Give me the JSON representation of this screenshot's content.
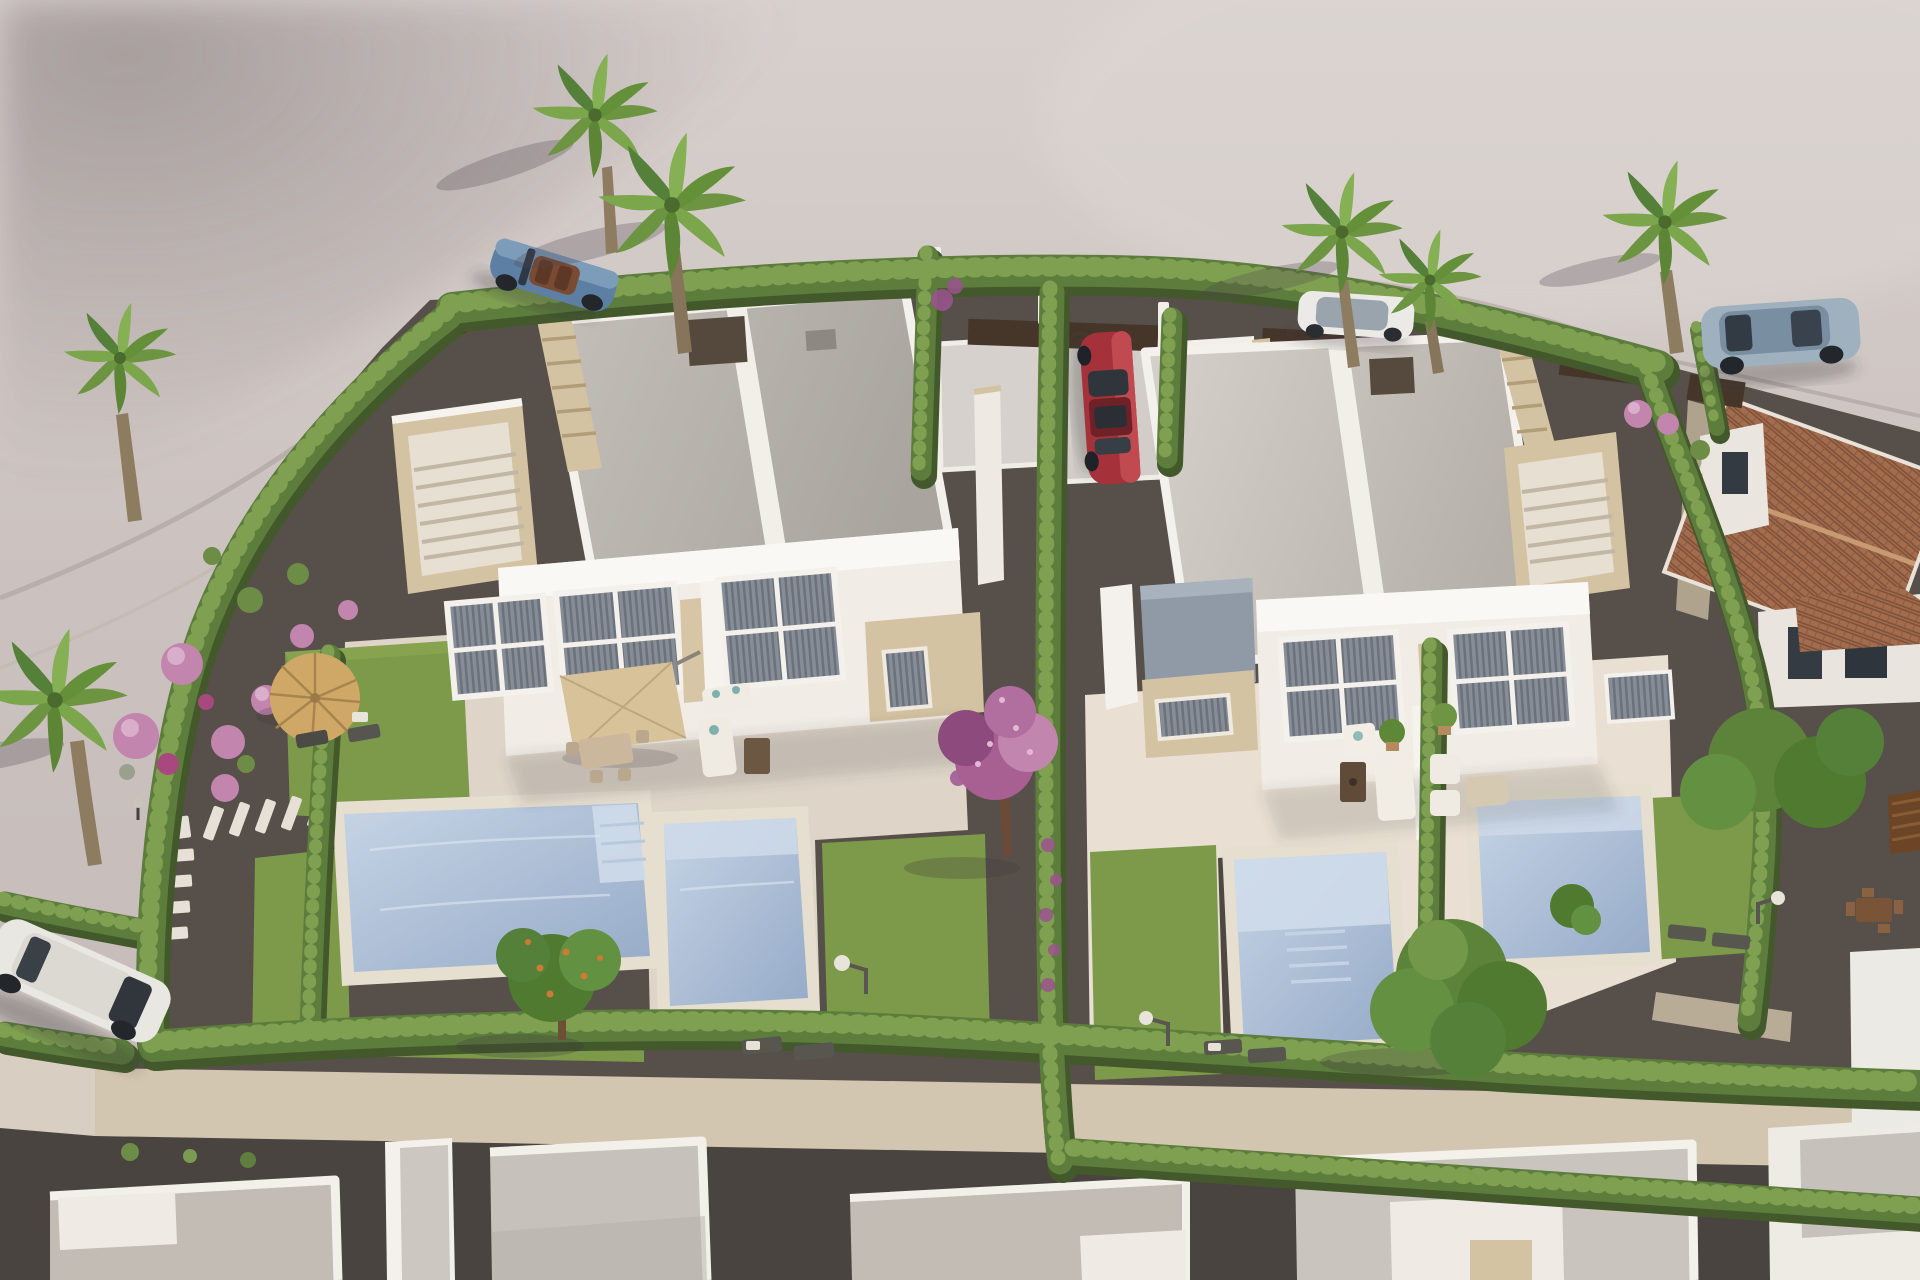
{
  "image": {
    "kind": "3d-architectural-render",
    "view": "aerial-oblique",
    "subject": "New-build residential development: two modern white duplex villas with private pools, lawned gardens, cypress hedges, palm trees, parked cars, a curving access road and neighbouring houses under construction",
    "lighting": "warm low sun from the upper right"
  },
  "inventory": {
    "duplex_villas": 2,
    "units_per_villa": 2,
    "private_pools": 4,
    "parked_cars": 5,
    "palm_trees": 7,
    "sun_parasols": 2,
    "tiled_roof_house": 1,
    "houses_under_construction_bottom": 5
  },
  "palette": {
    "road": "#cbc2bf",
    "road_light": "#d9d2cf",
    "road_shadow": "#a79d9b",
    "curb": "#b8aeab",
    "gravel": "#57504a",
    "sidewalk": "#d3c6b0",
    "bottom_road": "#49443f",
    "terrace": "#ded4c8",
    "terrace_light": "#e9dfd2",
    "lawn": "#7d9a4a",
    "hedge": "#5d7d3c",
    "hedge_light": "#7fa051",
    "hedge_dark": "#43592c",
    "pool_water": "#aec2d8",
    "pool_steps": "#cfdbea",
    "pool_coping": "#e6decf",
    "wall_white": "#f4f1ec",
    "wall_shaded": "#ddd7d0",
    "roof_gray": "#b7b2ac",
    "roof_light": "#ccc7c0",
    "stone_beige": "#d3c3a2",
    "stone_dark": "#b19e78",
    "window_glass": "#454c56",
    "fence_brown": "#46362a",
    "pergola_brown": "#6b4526",
    "tile_roof": "#a26c4e",
    "tile_dark": "#7e4f37",
    "palm_trunk": "#8d7c60",
    "palm_leaf": "#6d9440",
    "tree_green": "#55803a",
    "flower_pink": "#c285ad",
    "flower_magenta": "#9c5390",
    "car_blue": "#5d7fa3",
    "car_red": "#a5323a",
    "car_silver": "#9fb0bf",
    "car_white": "#eceae6",
    "porch_slate": "#8f9aa6",
    "shadow": "rgba(60,52,58,0.25)"
  }
}
